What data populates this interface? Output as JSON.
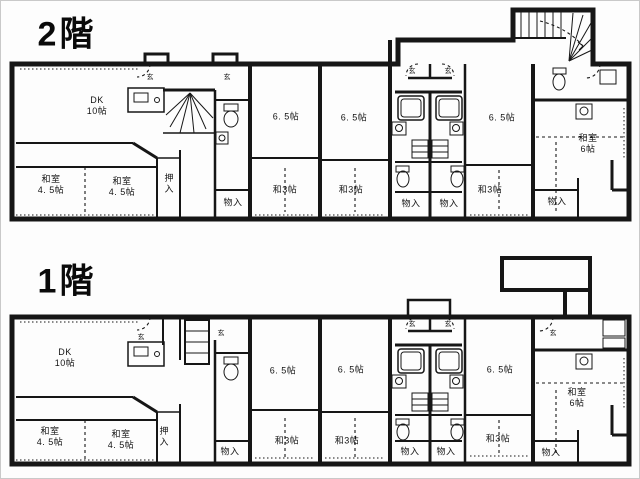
{
  "floor2": {
    "title": "2階",
    "rooms": {
      "dk": "DK\n10帖",
      "r65_a": "6. 5帖",
      "r65_b": "6. 5帖",
      "r65_c": "6. 5帖",
      "tatami6": "和室\n6帖",
      "tatami45_left": "和室\n4. 5帖",
      "tatami45_mid": "和室\n4. 5帖",
      "oshiire": "押入",
      "storage_left": "物入",
      "wa3_a": "和3帖",
      "wa3_b": "和3帖",
      "wa3_c": "和3帖",
      "storage_b1": "物入",
      "storage_b2": "物入",
      "storage_right": "物入",
      "genkan_a": "玄",
      "genkan_b": "玄",
      "genkan_c": "玄",
      "genkan_d": "玄"
    }
  },
  "floor1": {
    "title": "1階",
    "rooms": {
      "dk": "DK\n10帖",
      "r65_a": "6. 5帖",
      "r65_b": "6. 5帖",
      "r65_c": "6. 5帖",
      "tatami6": "和室\n6帖",
      "tatami45_left": "和室\n4. 5帖",
      "tatami45_mid": "和室\n4. 5帖",
      "oshiire": "押入",
      "storage_left": "物入",
      "wa3_a": "和3帖",
      "wa3_b": "和3帖",
      "wa3_c": "和3帖",
      "storage_b1": "物入",
      "storage_b2": "物入",
      "storage_right": "物入",
      "genkan_a": "玄",
      "genkan_b": "玄",
      "genkan_c": "玄",
      "genkan_d": "玄",
      "genkan_e": "玄"
    }
  }
}
